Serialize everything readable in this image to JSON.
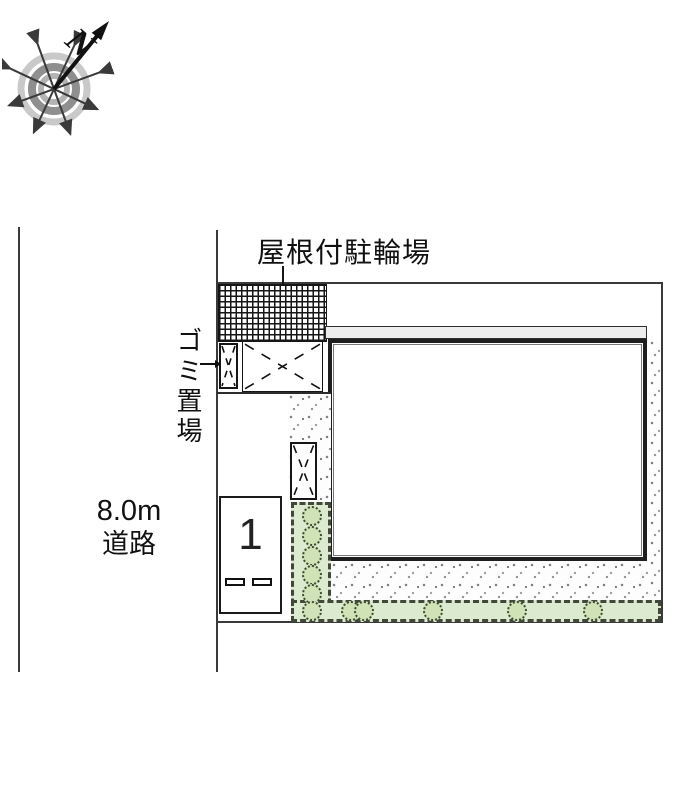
{
  "plan_title": "site plan with covered bicycle parking and one parking space",
  "compass": {
    "north_label": "N"
  },
  "labels": {
    "bicycle_parking": "屋根付駐輪場",
    "garbage": "ゴミ置場",
    "road_width": "8.0m",
    "road_name": "道路",
    "parking_space": "1"
  },
  "colors": {
    "hedge_green": "#dcead0",
    "bush_green": "#cfe3b6",
    "eave_gray": "#ededed",
    "line_dark": "#3a3a3a",
    "hatch_black": "#161616"
  },
  "icons": {
    "compass": "compass-rose-icon",
    "north_arrow": "north-arrow-icon",
    "garbage_pointer": "arrow-right-icon"
  }
}
